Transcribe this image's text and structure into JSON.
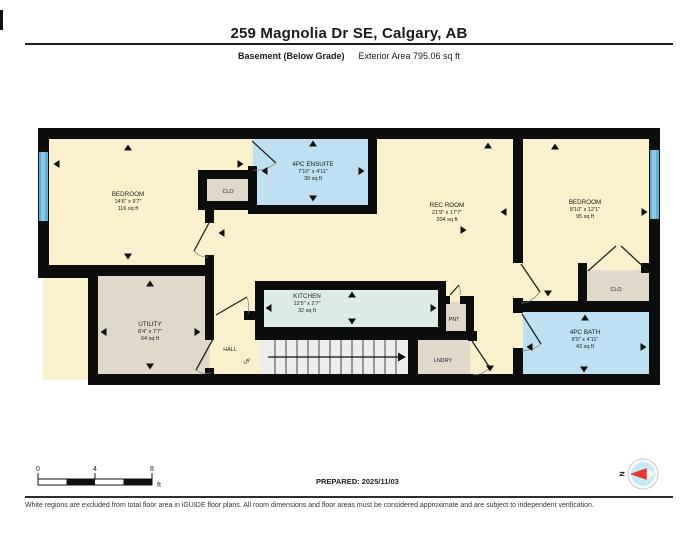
{
  "header": {
    "title": "259 Magnolia Dr SE, Calgary, AB",
    "floor_label": "Basement (Below Grade)",
    "area_label": "Exterior Area 795.06 sq ft"
  },
  "rooms": {
    "bedroom_left": {
      "name": "BEDROOM",
      "dims": "14'6\" x 9'7\"",
      "area": "116 sq ft"
    },
    "ensuite": {
      "name": "4PC ENSUITE",
      "dims": "7'10\" x 4'11\"",
      "area": "39 sq ft"
    },
    "closet_left": {
      "name": "CLO"
    },
    "rec_room": {
      "name": "REC ROOM",
      "dims": "21'9\" x 17'7\"",
      "area": "204 sq ft"
    },
    "bedroom_right": {
      "name": "BEDROOM",
      "dims": "8'10\" x 12'1\"",
      "area": "95 sq ft"
    },
    "closet_right": {
      "name": "CLO"
    },
    "bath": {
      "name": "4PC BATH",
      "dims": "8'9\" x 4'11\"",
      "area": "43 sq ft"
    },
    "utility": {
      "name": "UTILITY",
      "dims": "8'4\" x 7'7\"",
      "area": "64 sq ft"
    },
    "kitchen": {
      "name": "KITCHEN",
      "dims": "12'5\" x 2'7\"",
      "area": "32 sq ft"
    },
    "pantry": {
      "name": "PNT"
    },
    "laundry": {
      "name": "LNDRY"
    },
    "hall": {
      "name": "HALL"
    },
    "stairs": {
      "label": "UP"
    }
  },
  "scale_bar": {
    "ticks": [
      "0",
      "4",
      "8"
    ],
    "unit": "ft"
  },
  "footer": {
    "prepared": "PREPARED: 2025/11/03",
    "compass_label": "N",
    "disclaimer": "White regions are excluded from total floor area in iGUIDE floor plans. All room dimensions and floor areas must be considered approximate and are subject to independent verification."
  },
  "colors": {
    "wall": "#0d0d0d",
    "room_cream": "#FAF0CE",
    "room_tan": "#E0D8C9",
    "room_blue": "#BFE0F2",
    "room_teal": "#DDEDE5",
    "stairs_grey": "#EDEDED",
    "window_blue": "#64AFDA",
    "compass_red": "#E03C31"
  }
}
